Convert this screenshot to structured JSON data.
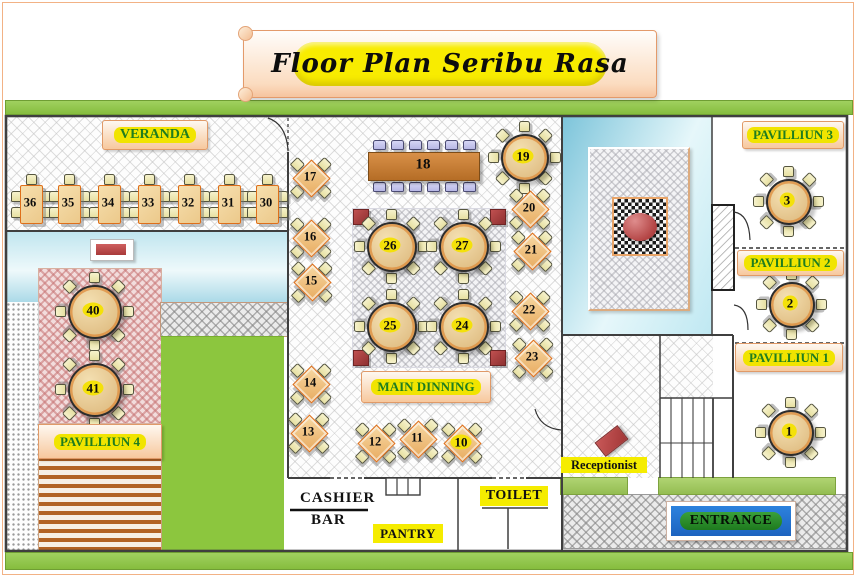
{
  "page": {
    "title": "Floor Plan Seribu Rasa"
  },
  "labels": {
    "veranda": "VERANDA",
    "pavilliun1": "PAVILLIUN 1",
    "pavilliun2": "PAVILLIUN 2",
    "pavilliun3": "PAVILLIUN 3",
    "pavilliun4": "PAVILLIUN 4",
    "main_dining": "MAIN DINNING",
    "receptionist": "Receptionist",
    "cashier": "CASHIER",
    "bar": "BAR",
    "pantry": "PANTRY",
    "toilet": "TOILET",
    "entrance": "ENTRANCE"
  },
  "tables": [
    {
      "number": "36",
      "kind": "rect",
      "x": 30,
      "y": 203
    },
    {
      "number": "35",
      "kind": "rect",
      "x": 68,
      "y": 203
    },
    {
      "number": "34",
      "kind": "rect",
      "x": 108,
      "y": 203
    },
    {
      "number": "33",
      "kind": "rect",
      "x": 148,
      "y": 203
    },
    {
      "number": "32",
      "kind": "rect",
      "x": 188,
      "y": 203
    },
    {
      "number": "31",
      "kind": "rect",
      "x": 228,
      "y": 203
    },
    {
      "number": "30",
      "kind": "rect",
      "x": 266,
      "y": 203
    },
    {
      "number": "18",
      "kind": "long",
      "x": 423,
      "y": 165
    },
    {
      "number": "19",
      "kind": "round",
      "x": 523,
      "y": 156,
      "r": 22,
      "badge": true
    },
    {
      "number": "26",
      "kind": "round",
      "x": 390,
      "y": 245,
      "r": 23,
      "badge": true
    },
    {
      "number": "27",
      "kind": "round",
      "x": 462,
      "y": 245,
      "r": 23,
      "badge": true
    },
    {
      "number": "25",
      "kind": "round",
      "x": 390,
      "y": 325,
      "r": 23,
      "badge": true
    },
    {
      "number": "24",
      "kind": "round",
      "x": 462,
      "y": 325,
      "r": 23,
      "badge": true
    },
    {
      "number": "40",
      "kind": "round",
      "x": 93,
      "y": 310,
      "r": 25,
      "badge": true
    },
    {
      "number": "41",
      "kind": "round",
      "x": 93,
      "y": 388,
      "r": 25,
      "badge": true
    },
    {
      "number": "3",
      "kind": "round",
      "x": 787,
      "y": 200,
      "r": 21,
      "badge": true
    },
    {
      "number": "2",
      "kind": "round",
      "x": 790,
      "y": 303,
      "r": 21,
      "badge": true
    },
    {
      "number": "1",
      "kind": "round",
      "x": 789,
      "y": 431,
      "r": 21,
      "badge": true
    },
    {
      "number": "17",
      "kind": "diamond",
      "x": 310,
      "y": 177
    },
    {
      "number": "16",
      "kind": "diamond",
      "x": 310,
      "y": 237
    },
    {
      "number": "15",
      "kind": "diamond",
      "x": 311,
      "y": 281
    },
    {
      "number": "14",
      "kind": "diamond",
      "x": 310,
      "y": 383
    },
    {
      "number": "13",
      "kind": "diamond",
      "x": 308,
      "y": 432
    },
    {
      "number": "12",
      "kind": "diamond",
      "x": 375,
      "y": 442
    },
    {
      "number": "11",
      "kind": "diamond",
      "x": 417,
      "y": 438
    },
    {
      "number": "10",
      "kind": "diamond",
      "x": 461,
      "y": 442,
      "badge": true
    },
    {
      "number": "20",
      "kind": "diamond",
      "x": 529,
      "y": 208
    },
    {
      "number": "21",
      "kind": "diamond",
      "x": 531,
      "y": 250
    },
    {
      "number": "22",
      "kind": "diamond",
      "x": 529,
      "y": 310
    },
    {
      "number": "23",
      "kind": "diamond",
      "x": 532,
      "y": 357
    }
  ],
  "colors": {
    "green_bar": "#8FC649",
    "label_text_green": "#1F7D1F",
    "highlight_yellow": "#F2E400",
    "banner_yellow": "#F8EC00",
    "table_tan": "#EDD5A3",
    "table_border_orange": "#DE6F1A",
    "wood_brown": "#C07F35",
    "red_accent": "#B84444",
    "grass_green": "#8CC63E",
    "pond_blue": "#A8DCEA",
    "carpet_pink": "#E9C9C9",
    "entrance_blue": "#2277D8",
    "entrance_green": "#2E8B2E"
  }
}
